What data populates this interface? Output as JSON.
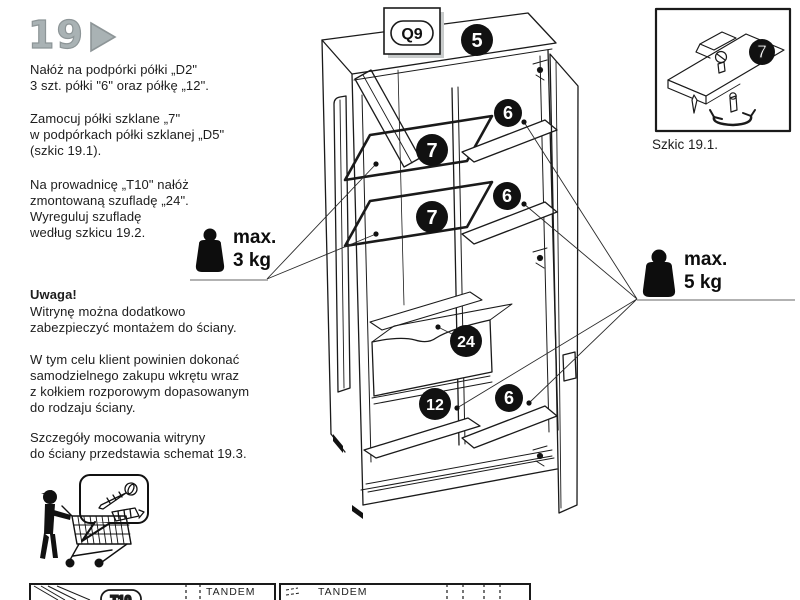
{
  "page": {
    "step_number": "19",
    "colors": {
      "accent_gray": "#a9b2b4",
      "line": "#1a1a1a",
      "background": "#ffffff"
    }
  },
  "instructions": {
    "p1": [
      "Nałóż na podpórki półki „D2\"",
      "3 szt. półki \"6\" oraz półkę „12\"."
    ],
    "p2": [
      "Zamocuj półki szklane „7\"",
      "w podpórkach półki szklanej „D5\"",
      "(szkic 19.1)."
    ],
    "p3": [
      "Na prowadnicę „T10\" nałóż",
      "zmontowaną szufladę „24\".",
      "Wyreguluj szufladę",
      "według szkicu 19.2."
    ],
    "warning_title": "Uwaga!",
    "p4": [
      "Witrynę można dodatkowo",
      "zabezpieczyć montażem do ściany."
    ],
    "p5": [
      "W tym celu klient powinien dokonać",
      "samodzielnego zakupu wkrętu wraz",
      "z kołkiem rozporowym dopasowanym",
      "do rodzaju ściany."
    ],
    "p6": [
      "Szczegóły mocowania witryny",
      "do ściany przedstawia schemat 19.3."
    ]
  },
  "diagram": {
    "hardware_tag": "Q9",
    "callouts": {
      "top_panel": "5",
      "glass_shelf_upper": "7",
      "glass_shelf_lower": "7",
      "shelf_top": "6",
      "shelf_middle": "6",
      "shelf_bottom": "6",
      "drawer": "24",
      "bottom_shelf": "12"
    }
  },
  "weight_limits": {
    "glass_shelves": {
      "label": "max.",
      "value": "3 kg"
    },
    "wooden_shelves": {
      "label": "max.",
      "value": "5 kg"
    }
  },
  "inset": {
    "caption": "Szkic 19.1.",
    "callout": "7"
  },
  "footer": {
    "left_box": {
      "tag": "T10",
      "brand": "TANDEM"
    },
    "right_box": {
      "brand": "TANDEM"
    }
  },
  "icons": {
    "step_arrow": "play-triangle",
    "weight": "kettlebell-weight",
    "shopper": "person-with-shopping-cart",
    "speech_bubble": "screw-and-wall-plug"
  }
}
